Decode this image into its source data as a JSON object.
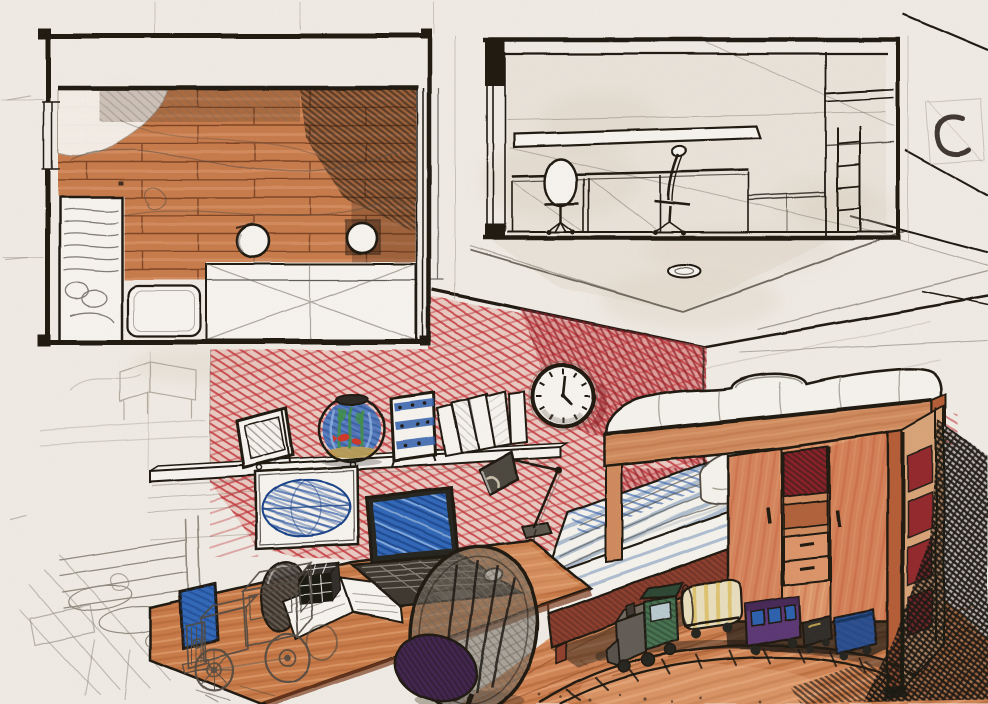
{
  "scene": {
    "title": "Hand-drawn interior design presentation of a kid's bedroom: floor plan, section view and a two-point perspective sketch",
    "medium": "marker, ballpoint pen and pencil on paper",
    "views": {
      "floor_plan": "Floor plan (top view) with parquet floor, bed, desk band and two stools",
      "section": "Section / elevation with two desk chairs, worktop, wall shelf and bunk ladder",
      "perspective": "Two-point perspective of the room with red feature wall"
    }
  },
  "objects": {
    "floor_plan": "floor plan drawing",
    "section_view": "section elevation drawing",
    "perspective_view": "perspective room sketch",
    "red_wall": "red feature wall in marker crosshatch",
    "right_wall": "side wall with pencil hatching",
    "ceiling": "ceiling with construction lines",
    "ceiling_lamp": "round ceiling lamp",
    "wall_clock": "round wall clock",
    "wall_shelf": "wall-mounted shelf",
    "picture_frame": "leaning picture frame",
    "fishbowl": "round fishbowl with goldfish and plants",
    "abacus": "toy abacus with blue bands",
    "books": "row of leaning books",
    "poster": "wall hanging with blue hatched oval",
    "desk_lamp": "articulated desk lamp",
    "laptop": "open laptop with blue screen",
    "mouse": "computer mouse",
    "open_book": "open notebook on desk",
    "cube_toy": "black grid cube toy",
    "toy_truck": "pencil wireframe sketch of a toy truck",
    "desk": "wooden corner desk",
    "side_screen": "second screen at desk edge",
    "dish_object": "dark bowl-shaped object on desk",
    "desk_chair": "egg-shell desk chair with purple cushion",
    "single_bed": "lower bed with striped bedding and pillow",
    "loft_bed": "loft bunk with white mattress on wooden beam",
    "wardrobe": "wardrobe with sliding doors, red cubby and drawers",
    "ladder": "bunk ladder with red gaps",
    "cast_shadow": "dark hatched cast shadow",
    "toy_train": "toy train: green loco, tank car, purple coach, blue wagon",
    "train_track": "curved toy railway track",
    "wood_floor": "orange wood plank floor",
    "pencil_studies": "faint pencil concept studies",
    "c_mark": "curved pen mark in margin"
  },
  "colors": {
    "paper": "#f1ede6",
    "paper_light": "#f8f5f0",
    "smudge": "#d9cdbc",
    "ink": "#1a1511",
    "pencil": "#6f675c",
    "pencil_light": "#a59c8f",
    "pencil_dark": "#4f483f",
    "wall_red": "#c23237",
    "wall_red_dark": "#8e1f27",
    "wall_red_base": "#e09a92",
    "plank_line": "#7d4322",
    "plan_wood": "#c87a4a",
    "plan_dark": "#3f2413",
    "floor_wood": "#d08352",
    "floor_streak_dark": "#a85a2c",
    "floor_streak_light": "#edb285",
    "desk_wood": "#c97a46",
    "desk_edge": "#7c3a1c",
    "ward_wood": "#dd9468",
    "ward_shade": "#c1502e",
    "ward_side": "#d9a377",
    "post_wood": "#b55c35",
    "beam_wood": "#d08a5c",
    "bedframe": "#8e3c2c",
    "mattress": "#f6f4ee",
    "stripe": "#90a7c4",
    "duvet_blue": "#3a69b0",
    "blanket_gray": "#9aa3ad",
    "screen_blue": "#2f66b8",
    "screen_dark": "#143f86",
    "screen_light": "#9fc2ec",
    "oval_blue": "#2d5cab",
    "water": "#3d74c4",
    "plant": "#3f8f46",
    "fish": "#d03527",
    "gravel": "#c2a04e",
    "loco_green": "#44714f",
    "loco_dark": "#2a4430",
    "metal_gray": "#5f5a52",
    "tank_cream": "#e9dfbe",
    "tank_yellow": "#d9b954",
    "coach_purple": "#5a3473",
    "window_blue": "#2c5fae",
    "wagon_blue": "#2b4d8c",
    "cushion": "#3f2350",
    "chair_shell": "#3c362e",
    "shadow": "#17130f"
  }
}
